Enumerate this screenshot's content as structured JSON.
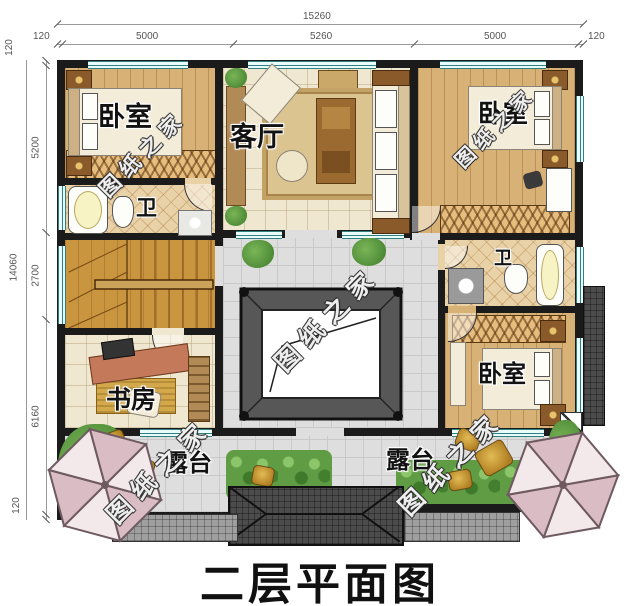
{
  "title": "二层平面图",
  "watermark": "图纸之家",
  "dimensions": {
    "top": {
      "total": "15260",
      "edge_left": "120",
      "seg1": "5000",
      "seg2": "5260",
      "seg3": "5000",
      "edge_right": "120"
    },
    "left": {
      "total": "14060",
      "edge_top": "120",
      "seg1": "5200",
      "seg2": "2700",
      "seg3": "6160",
      "edge_bottom": "120"
    }
  },
  "rooms": {
    "bedroom_top_left": "卧室",
    "living_room": "客厅",
    "bedroom_top_right": "卧室",
    "bathroom_left": "卫",
    "bathroom_right": "卫",
    "study": "书房",
    "bedroom_bottom_right": "卧室",
    "terrace_left": "露台",
    "terrace_right": "露台"
  },
  "colors": {
    "wall": "#1b1b1b",
    "window": "#e9fbfa",
    "window_frame": "#2f8080",
    "wood_floor": "#d8b176",
    "gray_tile": "#dedede",
    "roof": "#4c4c4c",
    "plant": "#5f9c44",
    "umbrella": "#d9bcc4",
    "gold": "#c79a36"
  }
}
